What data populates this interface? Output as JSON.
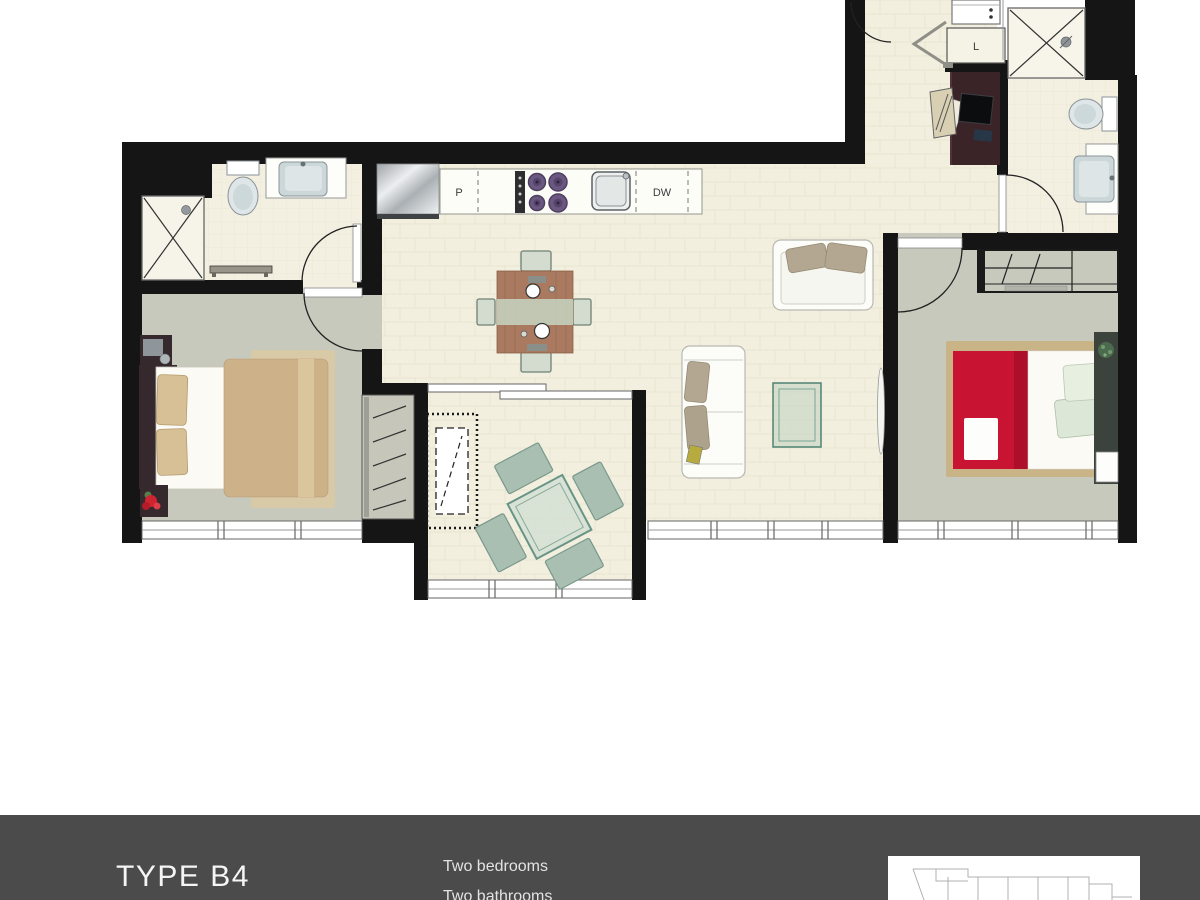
{
  "plan": {
    "labels": {
      "pantry": "P",
      "dishwasher": "DW",
      "linen": "L"
    }
  },
  "footer": {
    "title": "TYPE B4",
    "features": [
      "Two bedrooms",
      "Two bathrooms"
    ]
  },
  "colors": {
    "wall": "#151515",
    "floor_cream": "#f2efdf",
    "carpet_grey": "#c8c9bd",
    "bed_accent_red": "#c81332",
    "bed_accent_tan": "#ccb189",
    "outdoor_teal": "#679486",
    "footer_bg": "#4b4b4b",
    "footer_text": "#f5f5f5"
  }
}
